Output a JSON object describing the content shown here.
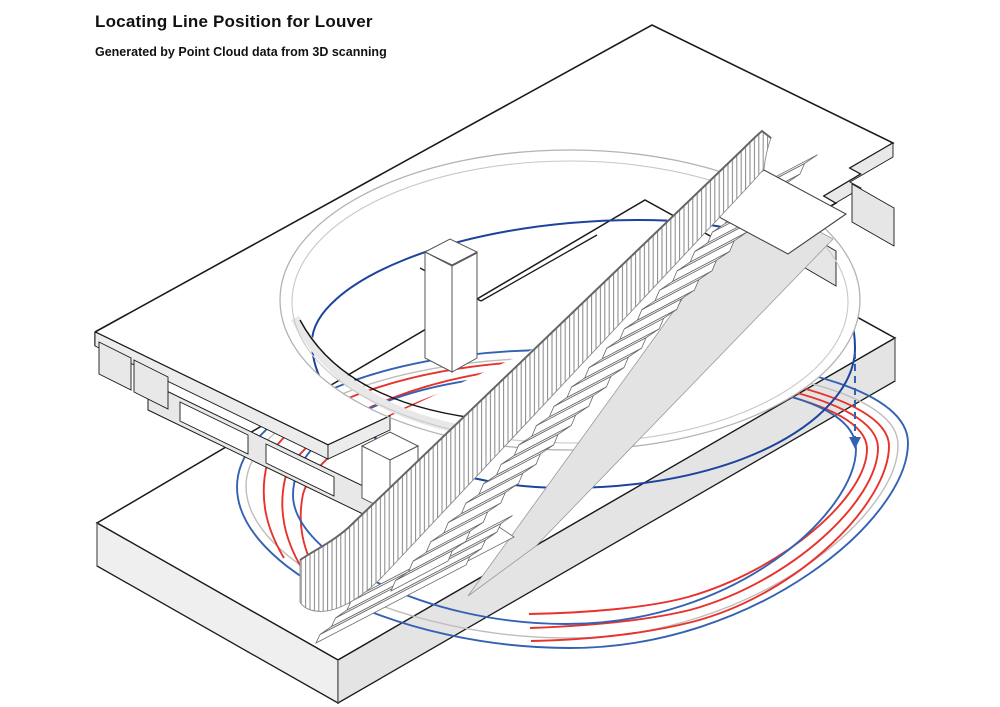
{
  "header": {
    "title": "Locating Line Position for Louver",
    "subtitle": "Generated by Point Cloud data from 3D scanning"
  },
  "diagram": {
    "type": "isometric-architectural-drawing",
    "description": "Two concrete floor slabs connected by a straight staircase through an elliptical stair void; concentric louver locating lines generated from 3D point cloud data encircle the void, with a dashed projection arrow from the upper line to the lower lines.",
    "colors": {
      "louver_line_red": "#e8322c",
      "louver_line_blue_lower": "#3462b3",
      "louver_line_blue_upper": "#1c449c",
      "void_rim_gray": "#b3b3b3",
      "slab_side_gray": "#e9e9e9",
      "outline": "#1a1a1a",
      "background": "#ffffff"
    },
    "counts": {
      "red_lines": 3,
      "blue_lines_lower": 2,
      "blue_lines_upper": 1,
      "stair_steps_main": 21,
      "stair_steps_entry": 3
    },
    "elements": [
      "upper-floor-slab",
      "lower-floor-slab",
      "stair-void-opening",
      "straight-staircase",
      "balustrade-railing",
      "upper-landing",
      "column",
      "pedestal",
      "louver-locating-lines",
      "projection-arrow"
    ]
  }
}
